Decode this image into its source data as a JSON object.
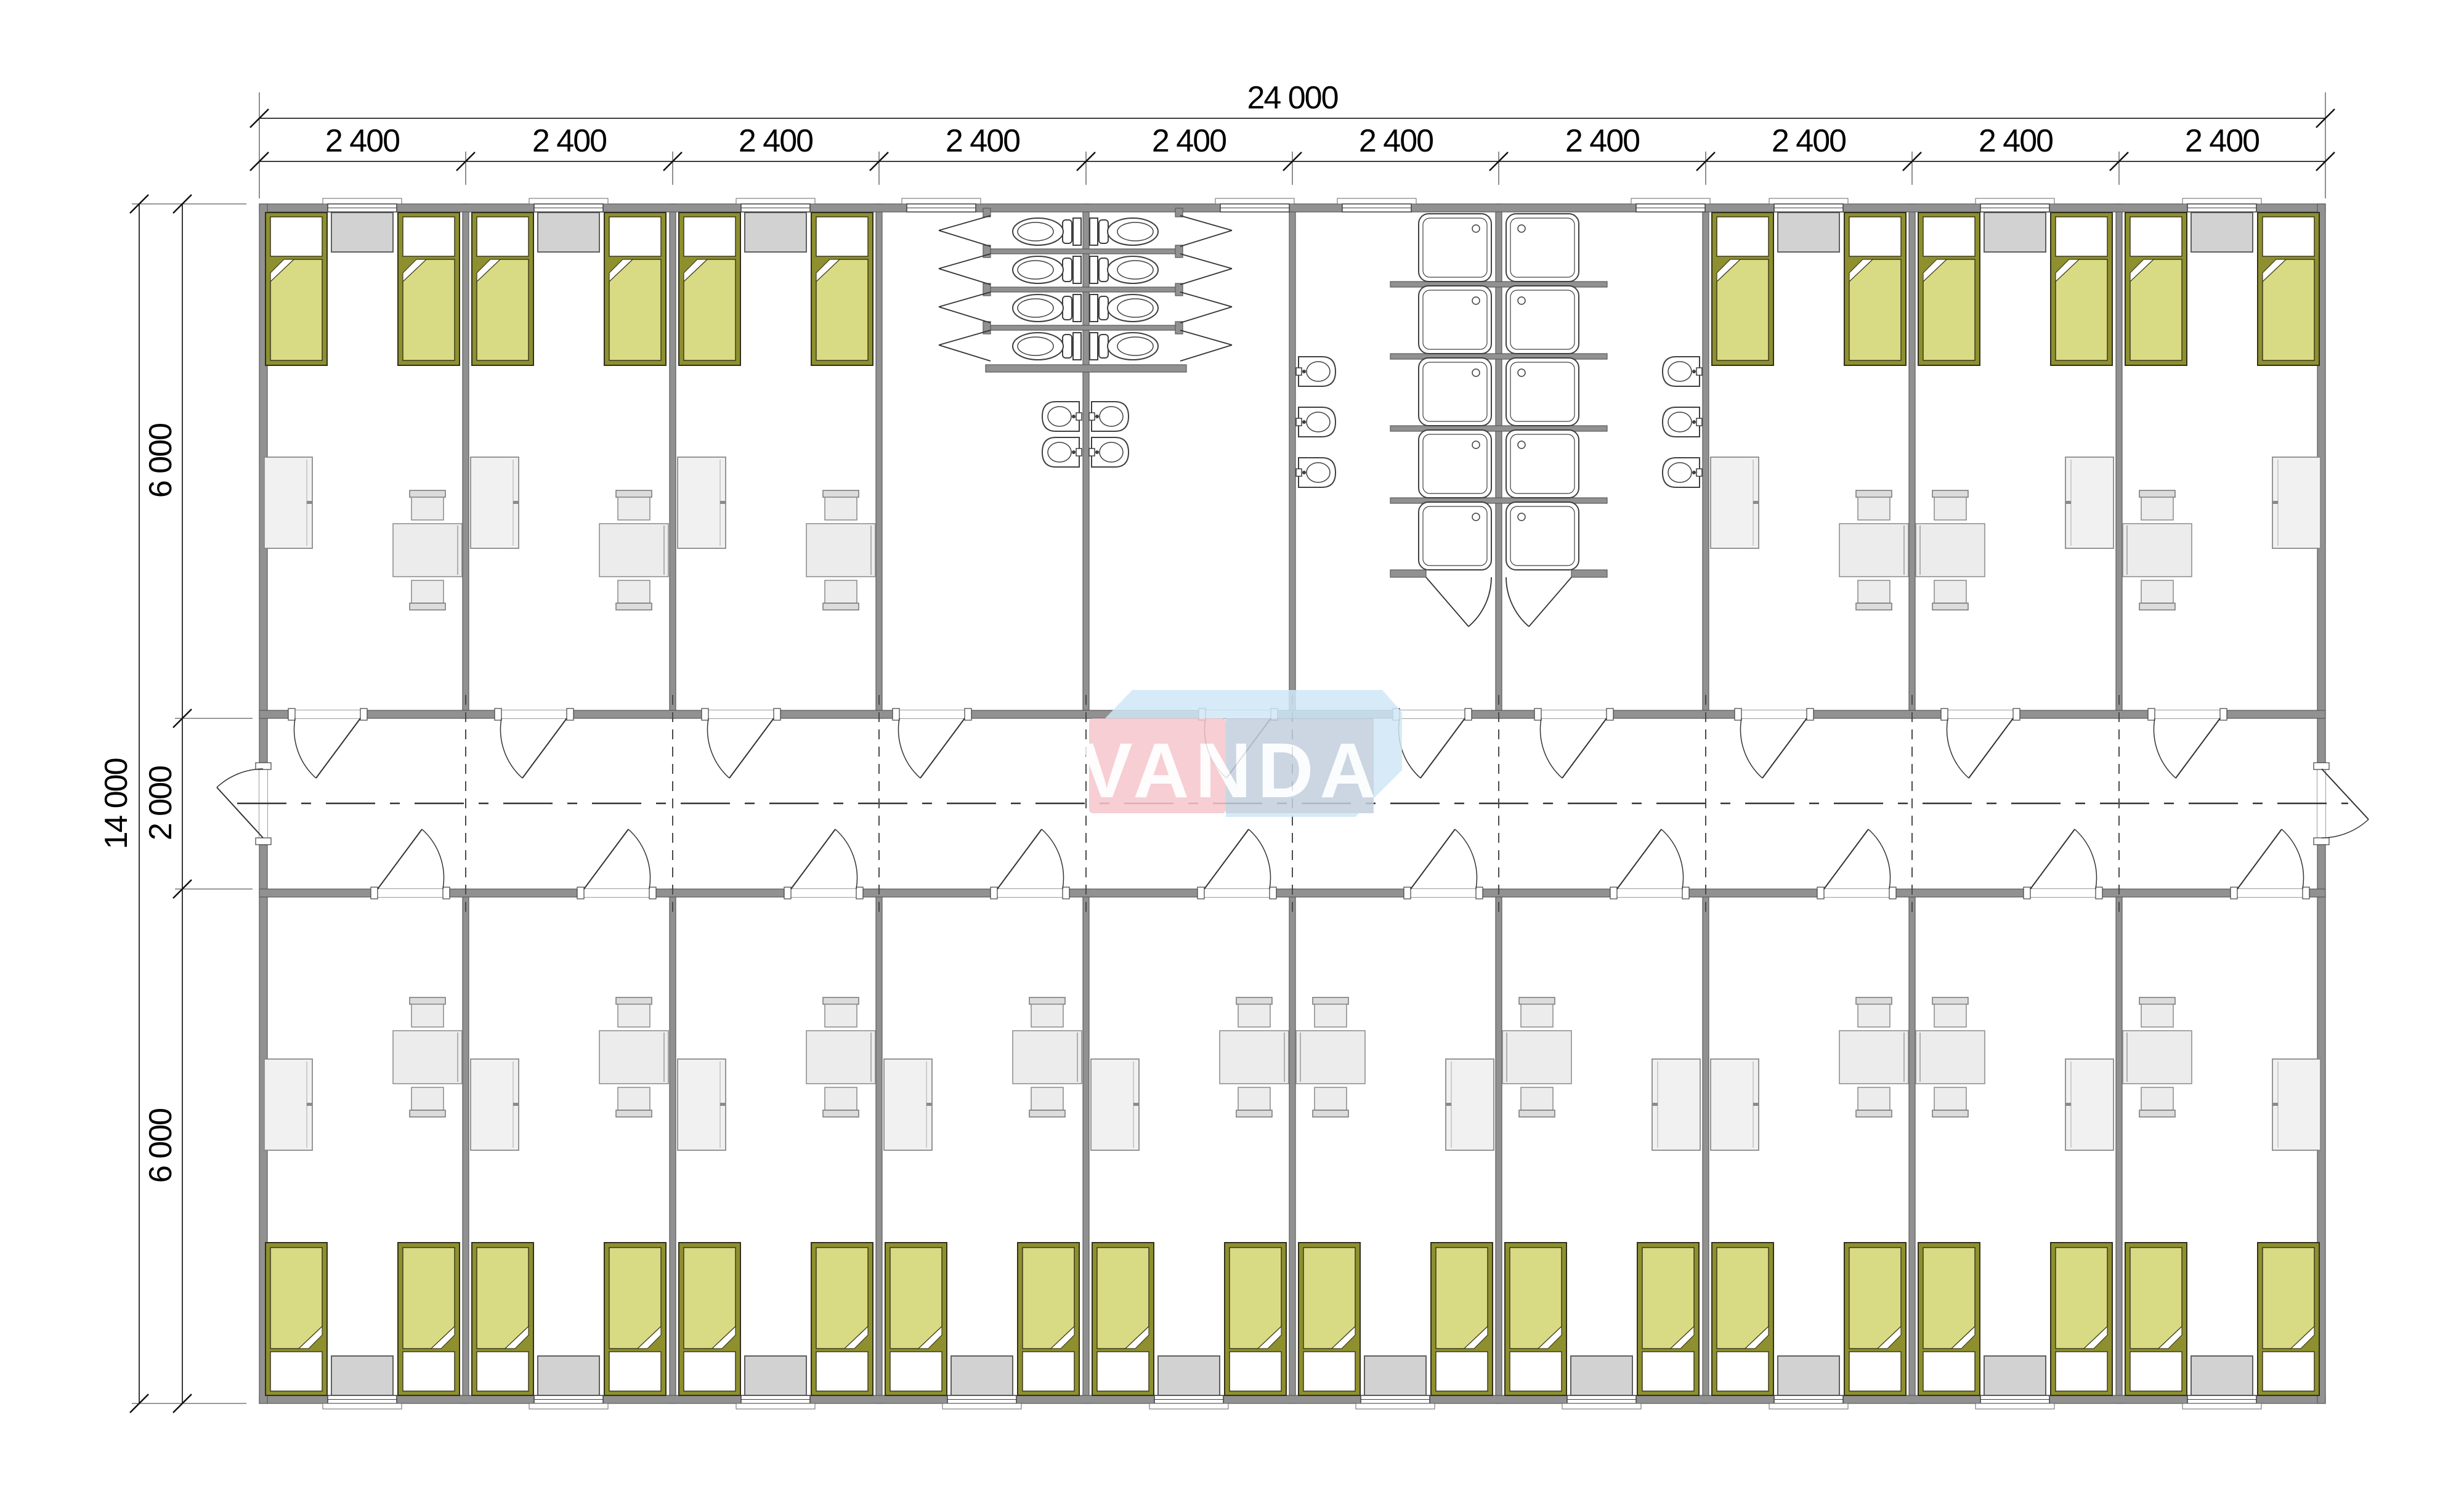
{
  "dimensions": {
    "total_width": "24 000",
    "module_widths": [
      "2 400",
      "2 400",
      "2 400",
      "2 400",
      "2 400",
      "2 400",
      "2 400",
      "2 400",
      "2 400",
      "2 400"
    ],
    "total_depth": "14 000",
    "depth_segments": [
      "6 000",
      "2 000",
      "6 000"
    ]
  },
  "logo": {
    "text": "VANDA"
  },
  "colors": {
    "wall": "#919191",
    "bed_fill": "#d9da84",
    "bed_frame": "#8e8f2f",
    "furniture": "#ececec",
    "locker": "#d2d2d2",
    "logo_pink": "#f5c6cc",
    "logo_blue_gray": "#c3cfdd",
    "logo_light_blue": "#cfe7f6"
  }
}
